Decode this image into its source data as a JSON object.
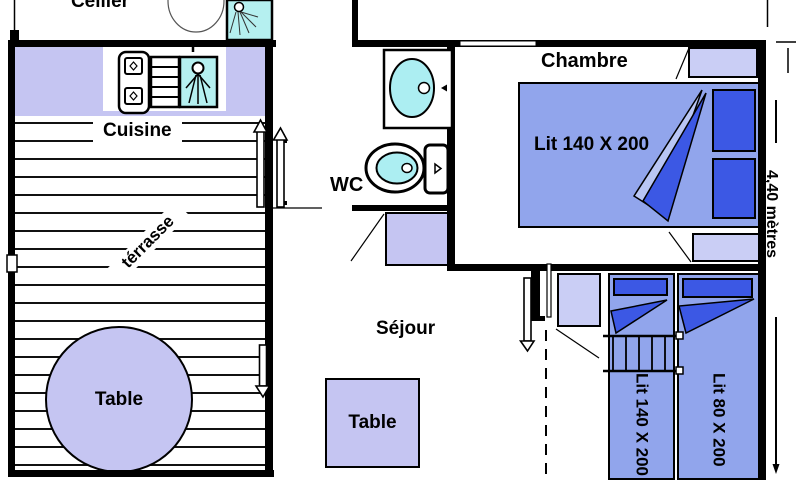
{
  "plan": {
    "rooms": {
      "cellier": "Cellier",
      "cuisine": "Cuisine",
      "terrasse": "térrasse",
      "wc": "WC",
      "sejour": "Séjour",
      "chambre": "Chambre"
    },
    "furniture": {
      "terrace_table": "Table",
      "sejour_table": "Table",
      "chambre_bed": "Lit 140 X 200",
      "bunk_bed": "Lit 140 X 200",
      "single_bed": "Lit 80 X 200"
    },
    "dimension": "4,40 mètres",
    "colors": {
      "wall": "#000000",
      "lavender": "#c5c5f2",
      "light_lavender": "#cacef5",
      "bed_blue": "#91a5ec",
      "dark_blue": "#3c58e4",
      "cyan": "#b5f0f0",
      "basin_cyan": "#aceef2"
    }
  }
}
